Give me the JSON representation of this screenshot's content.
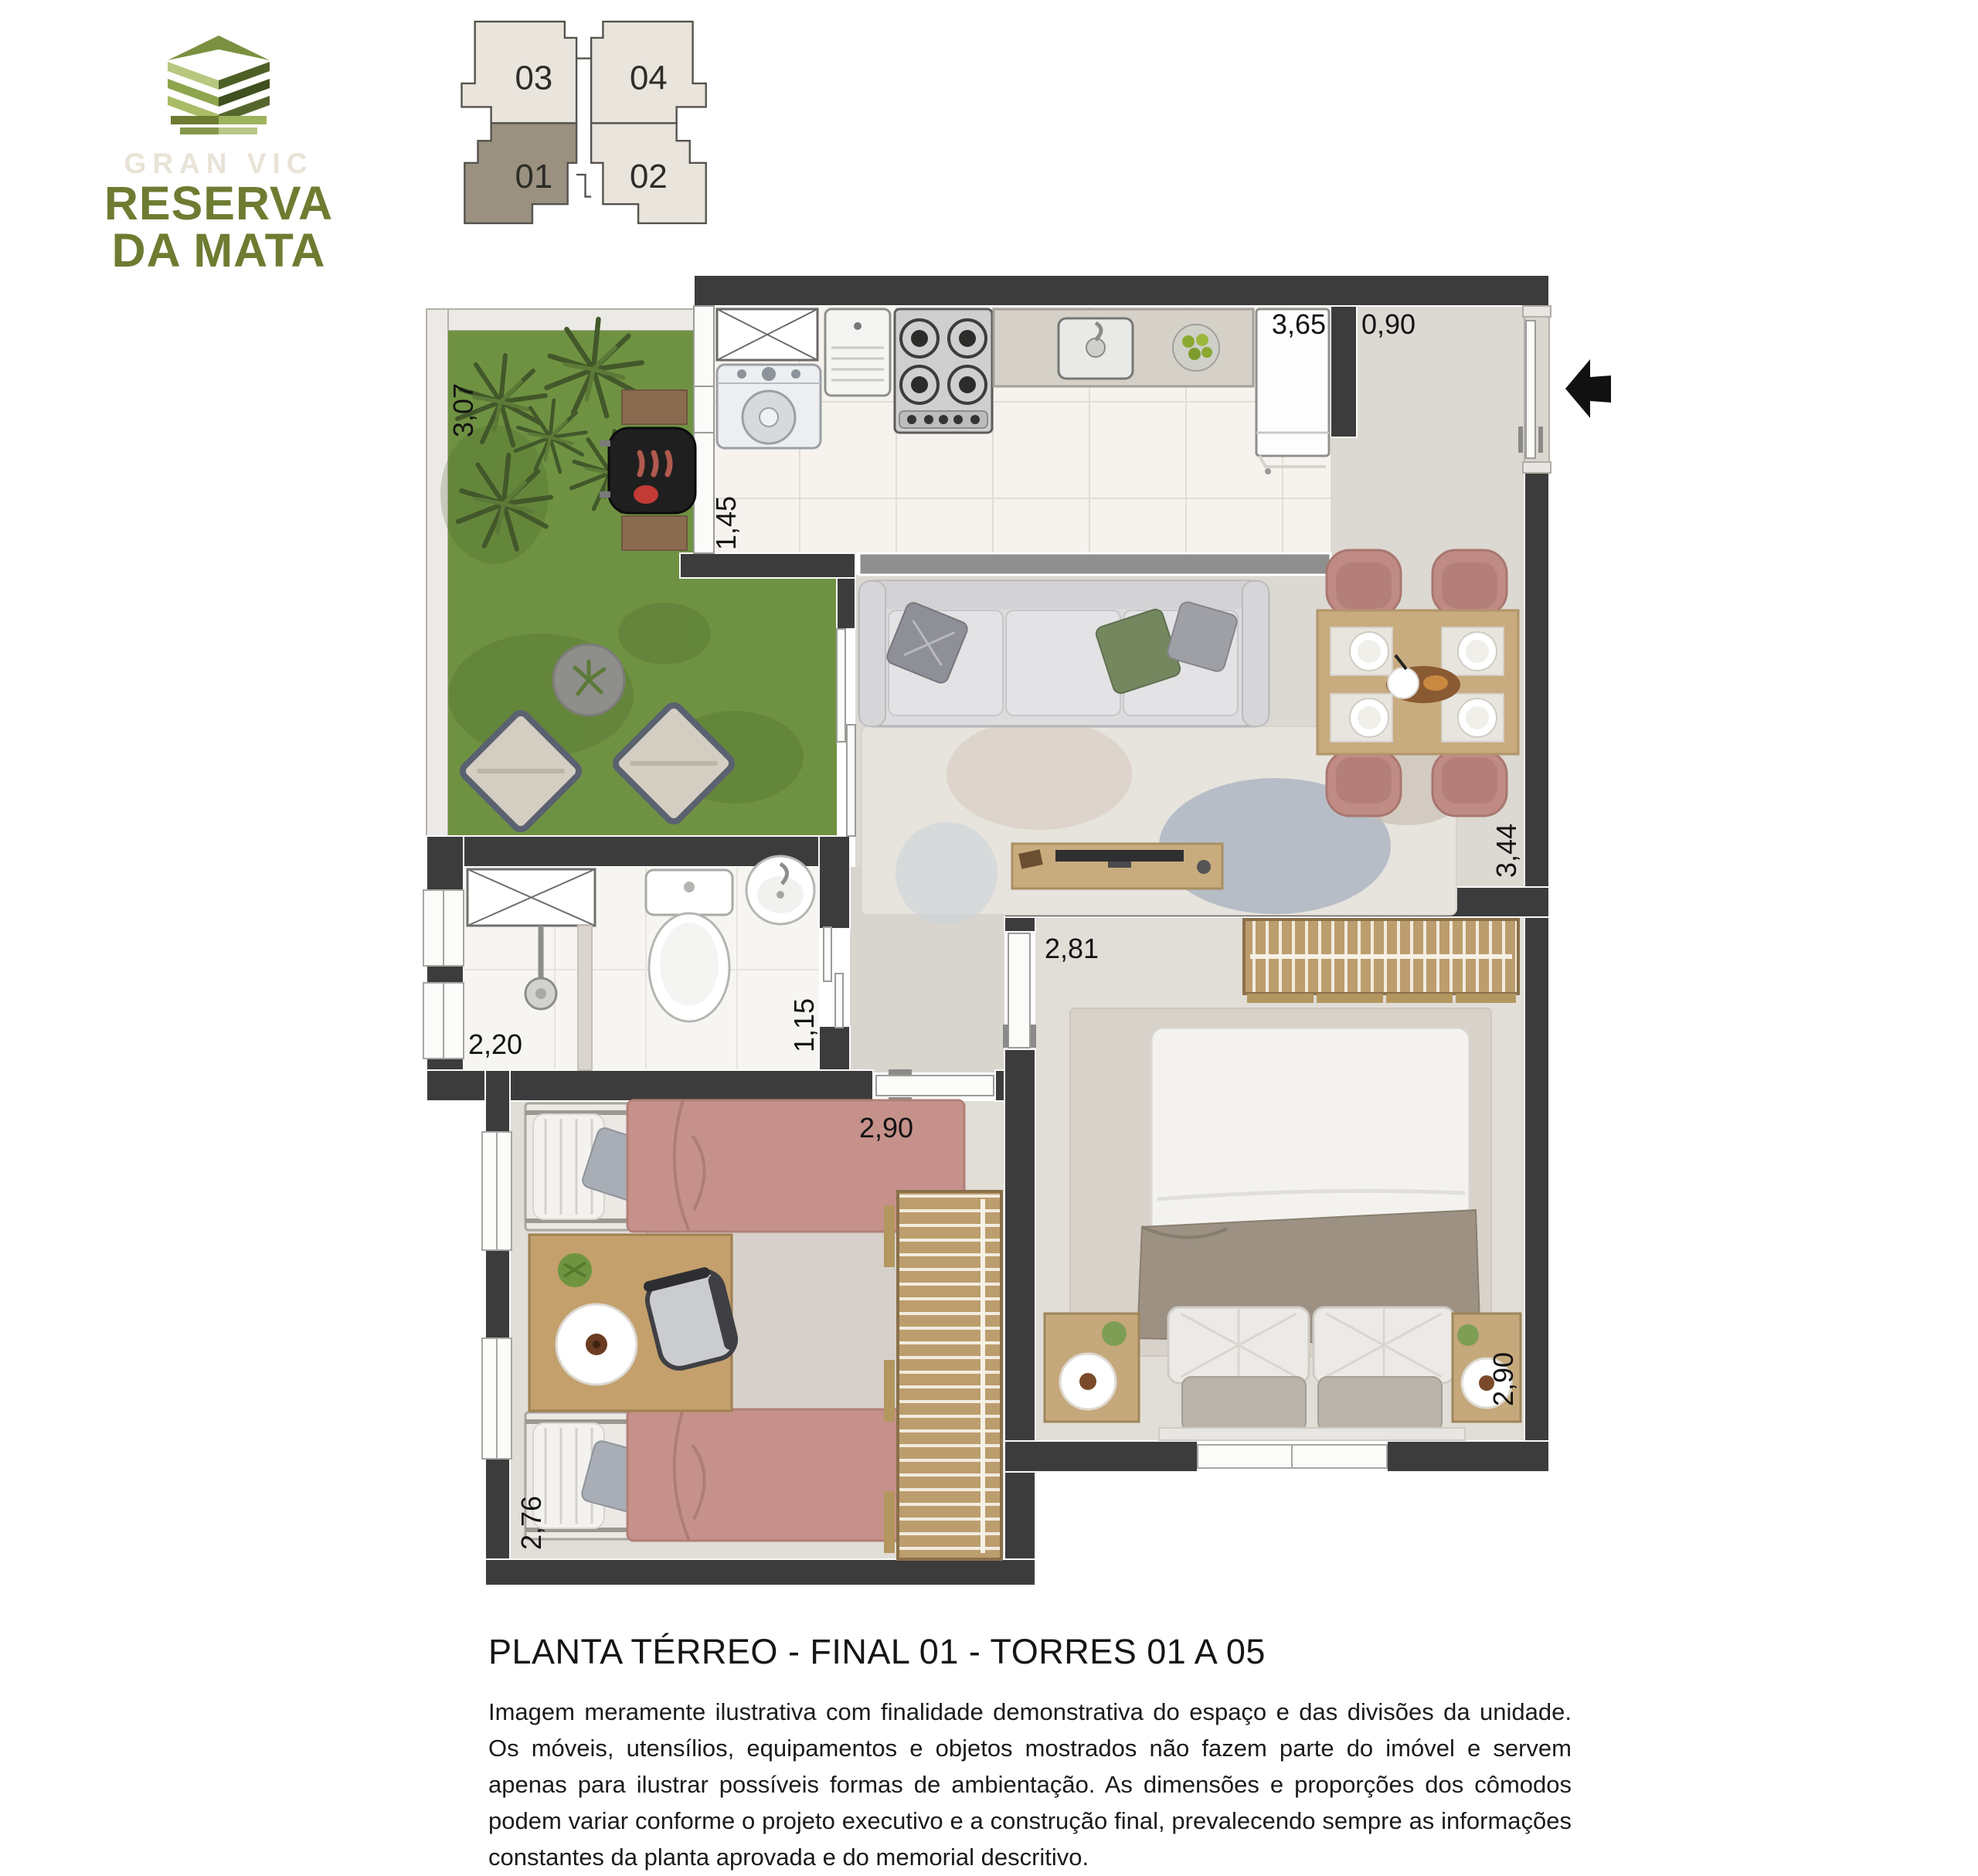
{
  "logo": {
    "brand": "GRAN VIC",
    "name_line1": "RESERVA",
    "name_line2": "DA MATA",
    "brand_color": "#6d7c31"
  },
  "keyplan": {
    "units": [
      {
        "label": "03",
        "highlighted": false
      },
      {
        "label": "04",
        "highlighted": false
      },
      {
        "label": "01",
        "highlighted": true
      },
      {
        "label": "02",
        "highlighted": false
      }
    ],
    "highlight_color": "#9a9180",
    "unit_color": "#e9e5dd"
  },
  "floorplan": {
    "dimensions": {
      "garden_depth": "3,07",
      "kitchen_width": "3,65",
      "entry_width": "0,90",
      "kitchen_door": "1,45",
      "living_depth": "3,44",
      "bathroom_width": "2,20",
      "bathroom_depth": "1,15",
      "bedroom1_width": "2,81",
      "bedroom1_depth": "2,90",
      "bedroom2_width": "2,90",
      "bedroom2_depth": "2,76"
    },
    "colors": {
      "wall": "#3d3c3c",
      "grass": "#6f9242",
      "bed_pink": "#c6918b",
      "chair_rose": "#c08b84",
      "wood": "#c3a579"
    }
  },
  "caption": {
    "title": "PLANTA TÉRREO - FINAL 01 - TORRES 01 A 05",
    "disclaimer": "Imagem meramente ilustrativa com finalidade demonstrativa do espaço e das divisões da unidade. Os móveis, utensílios, equipamentos e objetos mostrados não fazem parte do imóvel e servem apenas para ilustrar possíveis formas de ambientação. As dimensões e proporções dos cômodos podem variar conforme o projeto executivo e a construção final, prevalecendo sempre as informações constantes da planta aprovada e do memorial descritivo."
  }
}
